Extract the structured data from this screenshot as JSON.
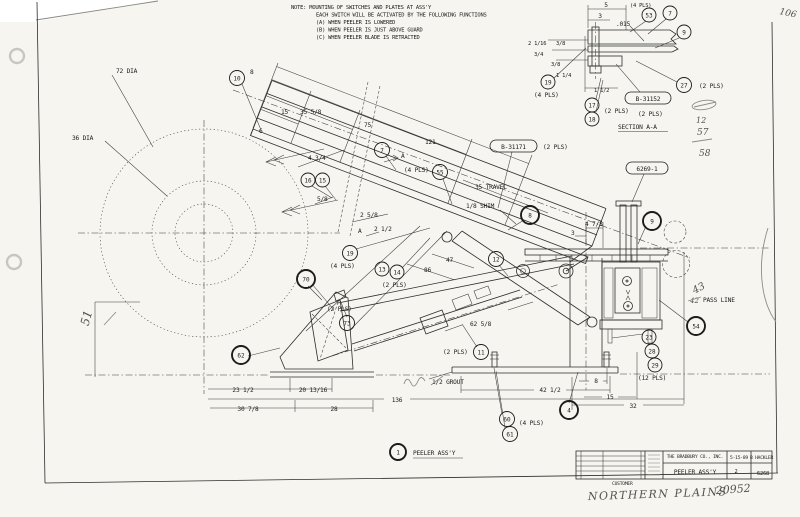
{
  "note": {
    "line1": "NOTE: MOUNTING OF SWITCHES AND PLATES AT ASS'Y",
    "line2": "EACH SWITCH WILL BE ACTIVATED BY THE FOLLOWING FUNCTIONS",
    "line3": "(A) WHEN PEELER IS LOWERED",
    "line4": "(B) WHEN PEELER IS JUST ABOVE GUARD",
    "line5": "(C) WHEN PEELER BLADE IS RETRACTED"
  },
  "labels": {
    "dia72": "72 DIA",
    "dia36": "36 DIA",
    "travel": "35 TRAVEL",
    "shim": "1/8 SHIM",
    "pass_line": "PASS LINE",
    "grout": "1/2 GROUT",
    "peeler_assy": "PEELER ASS'Y",
    "section_title": "SECTION A-A",
    "sec_arrow": "A"
  },
  "dims": {
    "d6": "6",
    "d8": "8",
    "d15": "15",
    "d35_58": "35 5/8",
    "d75": "75",
    "d121": "121",
    "d4_34": "4 3/4",
    "d5_8": "5/8",
    "d2_58": "2 5/8",
    "d2_12": "2 1/2",
    "d4_78": "4 7/8",
    "d3": "3",
    "d47": "47",
    "d86": "86",
    "d62_58": "62 5/8",
    "d23_12": "23 1/2",
    "d20_1316": "20 13/16",
    "d30_78": "30 7/8",
    "d28": "28",
    "d136": "136",
    "d42_12": "42 1/2",
    "d8b": "8",
    "d15b": "15",
    "d32": "32"
  },
  "section_dims": {
    "d5": "5",
    "d3": "3",
    "d015": ".015",
    "d2_116": "2 1/16",
    "d3_8a": "3/8",
    "d3_4": "3/4",
    "d3_8b": "3/8",
    "d1_14": "1 1/4",
    "d1_12": "1 1/2"
  },
  "balloons": {
    "b1": "1",
    "b4": "4",
    "b7": "7",
    "b8": "8",
    "b9": "9",
    "b10": "10",
    "b11": "11",
    "b12": "12",
    "b13": "13",
    "b14": "14",
    "b15": "15",
    "b16": "16",
    "b17": "17",
    "b18": "18",
    "b19": "19",
    "b23": "23",
    "b27": "27",
    "b28": "28",
    "b29": "29",
    "b53": "53",
    "b54": "54",
    "b55": "55",
    "b60": "60",
    "b61": "61",
    "b62": "62",
    "b70": "70",
    "b73": "73"
  },
  "pls": {
    "p2": "(2 PLS)",
    "p4": "(4 PLS)",
    "p12": "(12 PLS)"
  },
  "tags": {
    "t31171": "B-31171",
    "t31152": "B-31152",
    "t6269": "6269-1"
  },
  "titleblock": {
    "company": "THE BRADBURY CO., INC.",
    "drawing_title": "PEELER ASS'Y",
    "date": "5-15-89",
    "drawn_by": "B HACKLER",
    "drawing_no": "6268",
    "sheet": "2",
    "customer_label": "CUSTOMER"
  },
  "handwritten": {
    "corner": "106",
    "left_dim": "51",
    "col_a": "12",
    "col_b": "57",
    "col_c": "58",
    "pass_a": "43",
    "pass_b": "42",
    "customer": "NORTHERN PLAINS",
    "order": "20952"
  }
}
